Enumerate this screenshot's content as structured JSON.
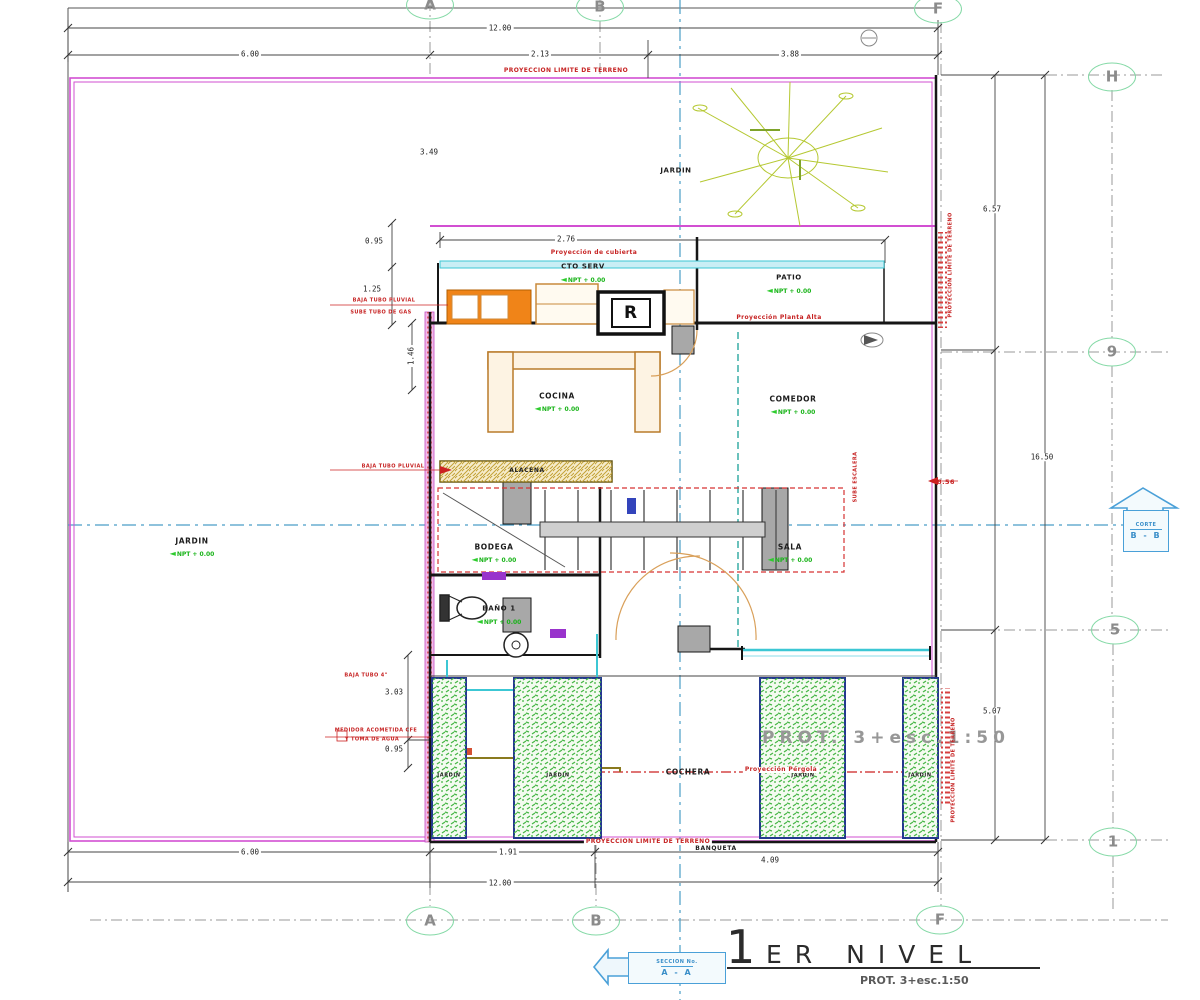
{
  "title": {
    "numeral": "1",
    "name": "ER NIVEL",
    "scale_note": "PROT. 3+esc.1:50"
  },
  "watermark": "PROT. 3+esc.1:50",
  "npt_text": "NPT + 0.00",
  "npt_arrow": "◄",
  "boiler_label": "R",
  "section_bottom": {
    "line1": "SECCION No.",
    "line2": "A - A"
  },
  "section_right": {
    "line1": "CORTE",
    "line2": "B - B"
  },
  "grid_bubbles": [
    {
      "label": "A",
      "x": 430,
      "y": 5
    },
    {
      "label": "B",
      "x": 600,
      "y": 7
    },
    {
      "label": "F",
      "x": 938,
      "y": 9
    },
    {
      "label": "H",
      "x": 1112,
      "y": 77
    },
    {
      "label": "9",
      "x": 1112,
      "y": 352
    },
    {
      "label": "5",
      "x": 1115,
      "y": 630
    },
    {
      "label": "1",
      "x": 1113,
      "y": 842
    },
    {
      "label": "A",
      "x": 430,
      "y": 921
    },
    {
      "label": "B",
      "x": 596,
      "y": 921
    },
    {
      "label": "F",
      "x": 940,
      "y": 920
    }
  ],
  "rooms": [
    {
      "id": "jardin-left",
      "text": "JARDIN",
      "x": 192,
      "y": 541,
      "s": 7.5,
      "npt": true,
      "nx": 192,
      "ny": 554
    },
    {
      "id": "jardin-top",
      "text": "JARDIN",
      "x": 676,
      "y": 171,
      "s": 7
    },
    {
      "id": "patio",
      "text": "PATIO",
      "x": 789,
      "y": 278,
      "s": 7,
      "npt": true,
      "nx": 789,
      "ny": 291
    },
    {
      "id": "cto-serv",
      "text": "CTO SERV",
      "x": 583,
      "y": 267,
      "s": 7,
      "npt": true,
      "nx": 583,
      "ny": 280
    },
    {
      "id": "cocina",
      "text": "COCINA",
      "x": 557,
      "y": 396,
      "s": 7.5,
      "npt": true,
      "nx": 557,
      "ny": 409
    },
    {
      "id": "comedor",
      "text": "COMEDOR",
      "x": 793,
      "y": 399,
      "s": 7.5,
      "npt": true,
      "nx": 793,
      "ny": 412
    },
    {
      "id": "bodega",
      "text": "BODEGA",
      "x": 494,
      "y": 547,
      "s": 7.5,
      "npt": true,
      "nx": 494,
      "ny": 560
    },
    {
      "id": "sala",
      "text": "SALA",
      "x": 790,
      "y": 547,
      "s": 7.5,
      "npt": true,
      "nx": 790,
      "ny": 560
    },
    {
      "id": "bano-1",
      "text": "BAÑO 1",
      "x": 499,
      "y": 609,
      "s": 7,
      "npt": true,
      "nx": 499,
      "ny": 622
    },
    {
      "id": "cochera",
      "text": "COCHERA",
      "x": 688,
      "y": 772,
      "s": 7.5
    },
    {
      "id": "jardin-p1",
      "text": "JARDIN",
      "x": 449,
      "y": 776,
      "s": 5
    },
    {
      "id": "jardin-p2",
      "text": "JARDIN",
      "x": 558,
      "y": 776,
      "s": 5
    },
    {
      "id": "jardin-p3",
      "text": "JARDIN",
      "x": 803,
      "y": 776,
      "s": 5
    },
    {
      "id": "jardin-p4",
      "text": "JARDIN",
      "x": 920,
      "y": 776,
      "s": 5
    },
    {
      "id": "banqueta",
      "text": "BANQUETA",
      "x": 716,
      "y": 849,
      "s": 6
    },
    {
      "id": "alacena",
      "text": "ALACENA",
      "x": 527,
      "y": 471,
      "s": 6
    }
  ],
  "dims": [
    {
      "text": "12.00",
      "x": 500,
      "y": 28
    },
    {
      "text": "6.00",
      "x": 250,
      "y": 54
    },
    {
      "text": "2.13",
      "x": 540,
      "y": 54
    },
    {
      "text": "3.88",
      "x": 790,
      "y": 54
    },
    {
      "text": "3.49",
      "x": 429,
      "y": 152
    },
    {
      "text": "0.95",
      "x": 374,
      "y": 241
    },
    {
      "text": "2.76",
      "x": 566,
      "y": 239
    },
    {
      "text": "1.25",
      "x": 372,
      "y": 289
    },
    {
      "text": "1.46",
      "x": 411,
      "y": 356,
      "rot": -90
    },
    {
      "text": "6.57",
      "x": 992,
      "y": 209
    },
    {
      "text": "16.50",
      "x": 1042,
      "y": 457
    },
    {
      "text": "3.03",
      "x": 394,
      "y": 692
    },
    {
      "text": "0.95",
      "x": 394,
      "y": 749
    },
    {
      "text": "5.07",
      "x": 992,
      "y": 711
    },
    {
      "text": "6.00",
      "x": 250,
      "y": 852
    },
    {
      "text": "1.91",
      "x": 508,
      "y": 852
    },
    {
      "text": "4.09",
      "x": 770,
      "y": 860
    },
    {
      "text": "12.00",
      "x": 500,
      "y": 883
    }
  ],
  "red_notes": [
    {
      "text": "PROYECCION LIMITE DE TERRENO",
      "x": 566,
      "y": 71,
      "s": 6
    },
    {
      "text": "Proyección de cubierta",
      "x": 594,
      "y": 253,
      "s": 6
    },
    {
      "text": "Proyección Planta Alta",
      "x": 779,
      "y": 318,
      "s": 6,
      "bg": true
    },
    {
      "text": "Proyección Pérgola",
      "x": 781,
      "y": 770,
      "s": 6,
      "bg": true
    },
    {
      "text": "PROYECCION LIMITE DE TERRENO",
      "x": 648,
      "y": 842,
      "s": 6,
      "bg": true
    },
    {
      "text": "PROYECCION LIMITE DE TERRENO",
      "x": 951,
      "y": 265,
      "s": 5,
      "rot": -90
    },
    {
      "text": "PROYECCION LIMITE DE TERRENO",
      "x": 954,
      "y": 770,
      "s": 5,
      "rot": -90
    },
    {
      "text": "BAJA TUBO PLUVIAL",
      "x": 384,
      "y": 301,
      "s": 5
    },
    {
      "text": "SUBE TUBO DE GAS",
      "x": 381,
      "y": 313,
      "s": 5
    },
    {
      "text": "BAJA TUBO PLUVIAL",
      "x": 393,
      "y": 467,
      "s": 5
    },
    {
      "text": "BAJA TUBO 4\"",
      "x": 366,
      "y": 676,
      "s": 5
    },
    {
      "text": "MEDIDOR ACOMETIDA CFE",
      "x": 376,
      "y": 731,
      "s": 5
    },
    {
      "text": "Y TOMA DE AGUA",
      "x": 372,
      "y": 740,
      "s": 5
    },
    {
      "text": "SUBE ESCALERA",
      "x": 856,
      "y": 477,
      "s": 5,
      "rot": -90
    },
    {
      "text": "8.56",
      "x": 946,
      "y": 482,
      "s": 6.5
    }
  ]
}
